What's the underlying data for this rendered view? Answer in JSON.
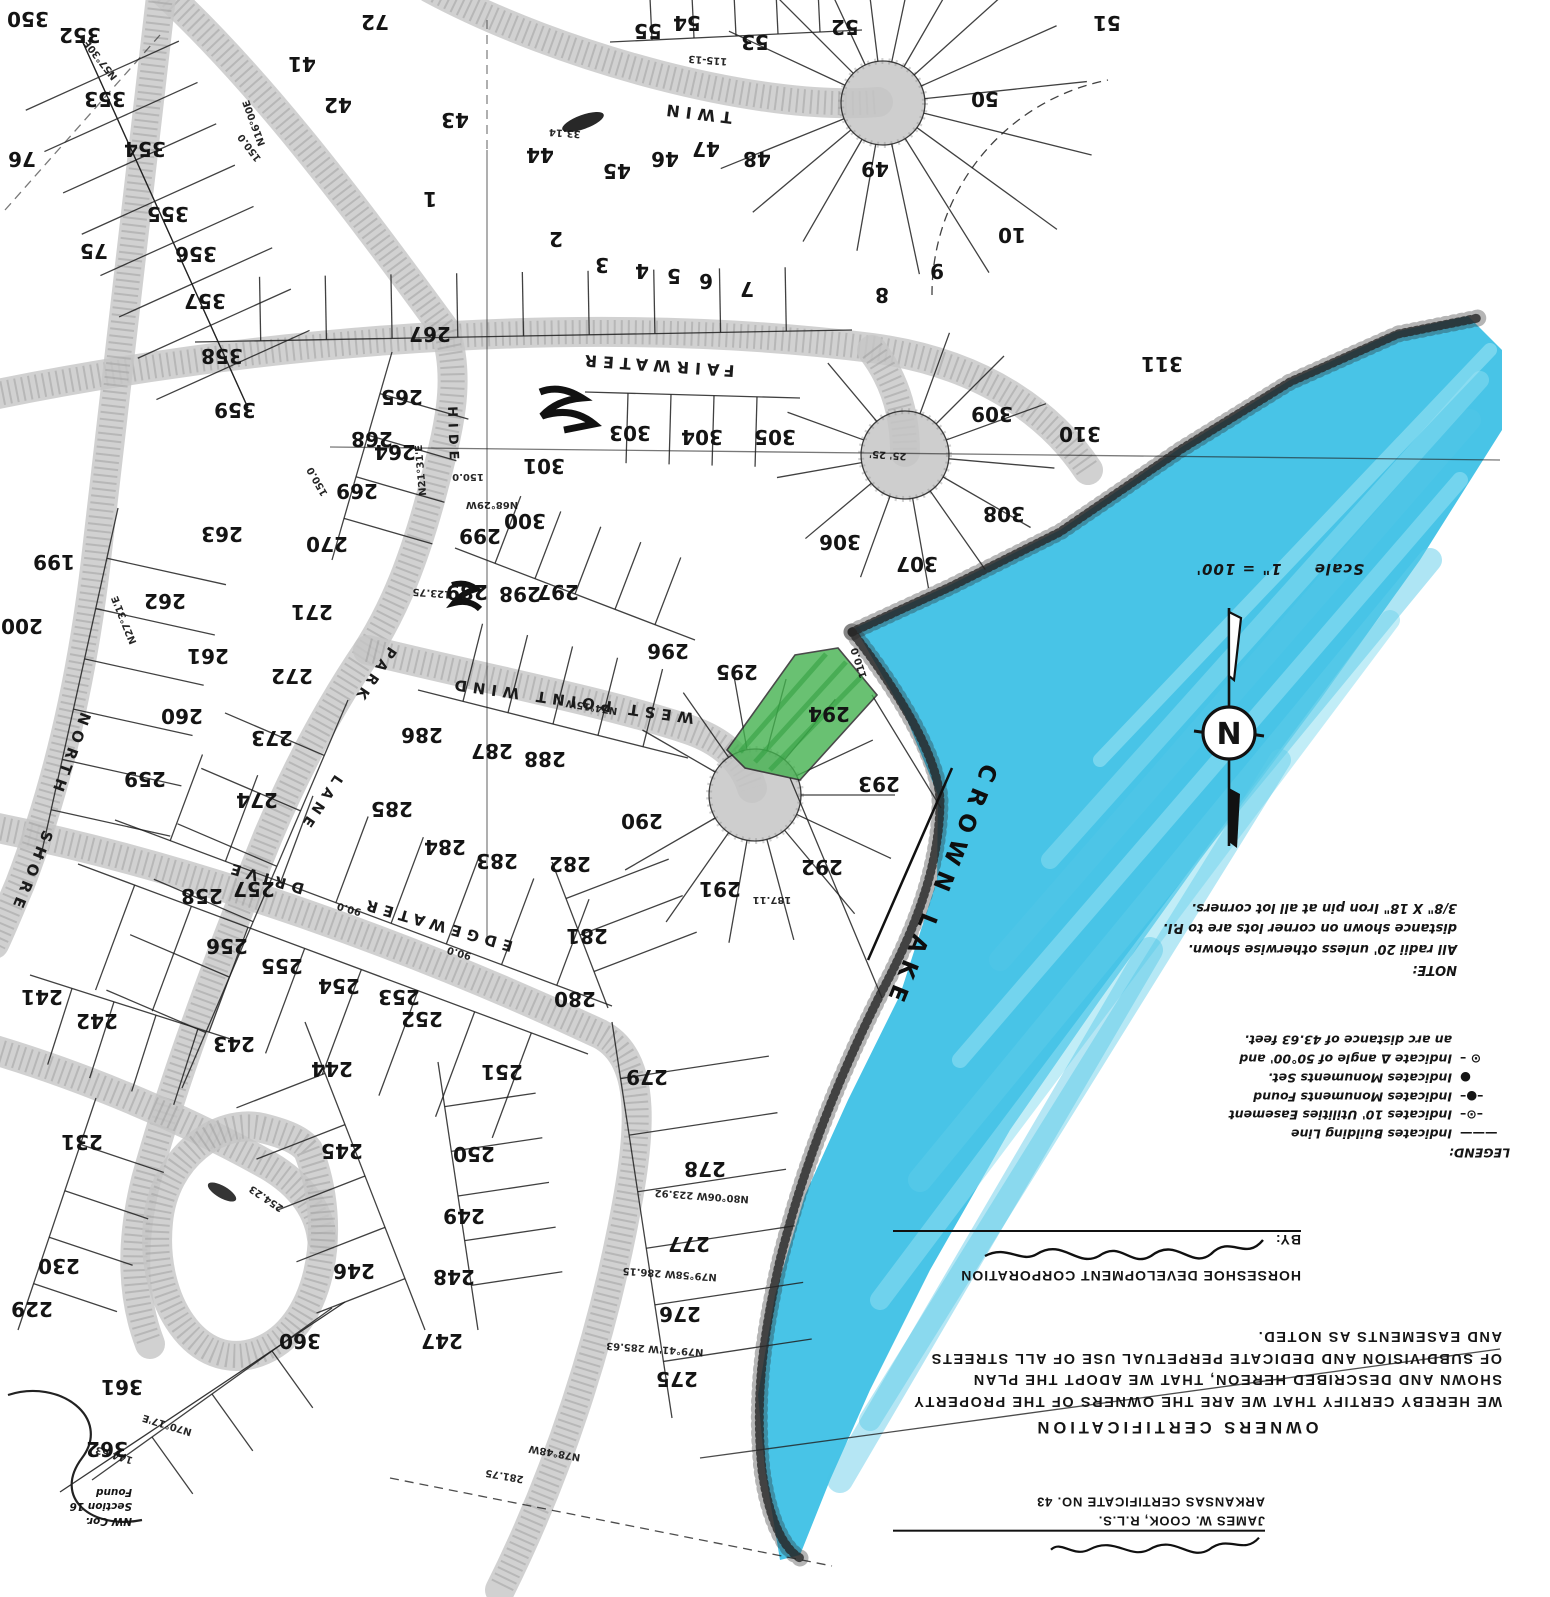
{
  "map": {
    "lake": {
      "name": "CROWN LAKE",
      "marker_color": "#2fbce4"
    },
    "highlight": {
      "lot": "294",
      "color": "#44b24f"
    },
    "scale_label": "Scale",
    "scale_value": "1\" = 100'",
    "north_letter": "N"
  },
  "streets": [
    {
      "name": "TWIN",
      "x": 697,
      "y": 108,
      "r": 187,
      "ls": 8,
      "size": 16
    },
    {
      "name": "FAIRWATER",
      "x": 657,
      "y": 360,
      "r": 184,
      "ls": 6,
      "size": 16
    },
    {
      "name": "WEST  POINT  WIND",
      "x": 572,
      "y": 696,
      "r": 188,
      "ls": 4,
      "size": 15
    },
    {
      "name": "EDGEWATER",
      "x": 438,
      "y": 920,
      "r": 196,
      "ls": 6,
      "size": 15
    },
    {
      "name": "DRIVE",
      "x": 266,
      "y": 873,
      "r": 196,
      "ls": 6,
      "size": 15
    },
    {
      "name": "NORTH",
      "x": 66,
      "y": 753,
      "r": 110,
      "ls": 7,
      "size": 15
    },
    {
      "name": "SHORE",
      "x": 27,
      "y": 870,
      "r": 112,
      "ls": 7,
      "size": 15
    },
    {
      "name": "PARK",
      "x": 371,
      "y": 673,
      "r": 124,
      "ls": 5,
      "size": 14
    },
    {
      "name": "LANE",
      "x": 317,
      "y": 801,
      "r": 124,
      "ls": 5,
      "size": 14
    },
    {
      "name": "HIDE",
      "x": 449,
      "y": 436,
      "r": 88,
      "ls": 6,
      "size": 13
    }
  ],
  "lots": [
    [
      "350",
      28,
      12
    ],
    [
      "352",
      80,
      28
    ],
    [
      "353",
      105,
      92
    ],
    [
      "354",
      145,
      142
    ],
    [
      "355",
      168,
      207
    ],
    [
      "356",
      196,
      247
    ],
    [
      "357",
      205,
      294
    ],
    [
      "358",
      222,
      349
    ],
    [
      "359",
      235,
      403
    ],
    [
      "76",
      22,
      152
    ],
    [
      "75",
      94,
      244
    ],
    [
      "72",
      375,
      15
    ],
    [
      "41",
      302,
      57
    ],
    [
      "42",
      338,
      98
    ],
    [
      "43",
      455,
      113
    ],
    [
      "44",
      540,
      148
    ],
    [
      "45",
      617,
      164
    ],
    [
      "46",
      665,
      152
    ],
    [
      "47",
      706,
      142
    ],
    [
      "48",
      757,
      152
    ],
    [
      "49",
      875,
      162
    ],
    [
      "50",
      985,
      92
    ],
    [
      "51",
      1107,
      16
    ],
    [
      "52",
      845,
      20
    ],
    [
      "53",
      755,
      35
    ],
    [
      "54",
      687,
      16
    ],
    [
      "55",
      648,
      24
    ],
    [
      "1",
      430,
      192
    ],
    [
      "2",
      556,
      232
    ],
    [
      "3",
      602,
      258
    ],
    [
      "4",
      642,
      264
    ],
    [
      "5",
      674,
      269
    ],
    [
      "6",
      706,
      274
    ],
    [
      "7",
      747,
      282
    ],
    [
      "8",
      882,
      288
    ],
    [
      "9",
      937,
      264
    ],
    [
      "10",
      1012,
      228
    ],
    [
      "199",
      54,
      555
    ],
    [
      "200",
      22,
      619
    ],
    [
      "259",
      145,
      772
    ],
    [
      "260",
      182,
      709
    ],
    [
      "261",
      208,
      649
    ],
    [
      "262",
      165,
      594
    ],
    [
      "263",
      222,
      527
    ],
    [
      "264",
      395,
      445
    ],
    [
      "265",
      402,
      390
    ],
    [
      "267",
      430,
      327
    ],
    [
      "268",
      372,
      432
    ],
    [
      "269",
      357,
      484
    ],
    [
      "270",
      327,
      537
    ],
    [
      "271",
      312,
      605
    ],
    [
      "272",
      292,
      669
    ],
    [
      "273",
      272,
      731
    ],
    [
      "274",
      257,
      793
    ],
    [
      "285",
      392,
      802
    ],
    [
      "286",
      422,
      728
    ],
    [
      "287",
      492,
      744
    ],
    [
      "288",
      545,
      752
    ],
    [
      "289",
      467,
      585
    ],
    [
      "298",
      520,
      587
    ],
    [
      "297",
      558,
      585
    ],
    [
      "296",
      668,
      644
    ],
    [
      "295",
      737,
      665
    ],
    [
      "299",
      480,
      529
    ],
    [
      "300",
      525,
      514
    ],
    [
      "301",
      544,
      459
    ],
    [
      "303",
      630,
      426
    ],
    [
      "304",
      702,
      430
    ],
    [
      "305",
      775,
      430
    ],
    [
      "306",
      840,
      535
    ],
    [
      "307",
      917,
      557
    ],
    [
      "308",
      1004,
      507
    ],
    [
      "309",
      992,
      407
    ],
    [
      "310",
      1080,
      427
    ],
    [
      "311",
      1162,
      357
    ],
    [
      "290",
      642,
      814
    ],
    [
      "291",
      720,
      882
    ],
    [
      "292",
      822,
      860
    ],
    [
      "293",
      879,
      777
    ],
    [
      "294",
      829,
      707
    ],
    [
      "282",
      570,
      857
    ],
    [
      "283",
      497,
      854
    ],
    [
      "284",
      445,
      840
    ],
    [
      "281",
      587,
      929
    ],
    [
      "280",
      575,
      992
    ],
    [
      "279",
      647,
      1070
    ],
    [
      "278",
      705,
      1162
    ],
    [
      "277",
      689,
      1237
    ],
    [
      "276",
      680,
      1307
    ],
    [
      "275",
      677,
      1372
    ],
    [
      "258",
      202,
      889
    ],
    [
      "257",
      254,
      882
    ],
    [
      "256",
      227,
      939
    ],
    [
      "255",
      282,
      959
    ],
    [
      "254",
      339,
      979
    ],
    [
      "253",
      399,
      990
    ],
    [
      "252",
      422,
      1012
    ],
    [
      "251",
      502,
      1065
    ],
    [
      "250",
      474,
      1147
    ],
    [
      "249",
      464,
      1209
    ],
    [
      "248",
      454,
      1270
    ],
    [
      "247",
      442,
      1334
    ],
    [
      "246",
      354,
      1264
    ],
    [
      "245",
      342,
      1144
    ],
    [
      "244",
      332,
      1062
    ],
    [
      "243",
      234,
      1037
    ],
    [
      "242",
      97,
      1014
    ],
    [
      "241",
      42,
      990
    ],
    [
      "231",
      82,
      1135
    ],
    [
      "230",
      59,
      1259
    ],
    [
      "229",
      32,
      1302
    ],
    [
      "360",
      300,
      1334
    ],
    [
      "361",
      122,
      1380
    ],
    [
      "362",
      107,
      1442
    ]
  ],
  "bearings": [
    [
      "N70°17'E",
      168,
      1422,
      197
    ],
    [
      "144.63",
      115,
      1452,
      197
    ],
    [
      "N78°48W",
      555,
      1450,
      190
    ],
    [
      "281.75",
      505,
      1473,
      190
    ],
    [
      "N79°41'W 285.63",
      655,
      1346,
      184
    ],
    [
      "N79°58W 286.15",
      670,
      1271,
      184
    ],
    [
      "N80°06W 223.92",
      702,
      1193,
      184
    ],
    [
      "N68°29W",
      492,
      502,
      180
    ],
    [
      "150.0",
      468,
      474,
      180
    ],
    [
      "150.0",
      252,
      146,
      233
    ],
    [
      "N27°31'E",
      127,
      619,
      248
    ],
    [
      "N57°30E",
      103,
      58,
      232
    ],
    [
      "187.11",
      772,
      897,
      180
    ],
    [
      "N74°15W",
      592,
      704,
      189
    ],
    [
      "25' 25'",
      888,
      452,
      184
    ],
    [
      "115-13",
      708,
      57,
      184
    ],
    [
      "110.0",
      862,
      662,
      252
    ],
    [
      "33.14",
      565,
      130,
      184
    ],
    [
      "N16°00E",
      257,
      122,
      250
    ],
    [
      "90.0",
      350,
      906,
      196
    ],
    [
      "90.0",
      460,
      950,
      196
    ],
    [
      "N21°31'E",
      424,
      470,
      265
    ],
    [
      "123.75",
      432,
      590,
      184
    ],
    [
      "254.23",
      268,
      1196,
      214
    ],
    [
      "150.0",
      320,
      480,
      240
    ]
  ],
  "blocks": {
    "note": {
      "title": "NOTE:",
      "lines": [
        "All radii 20' unless otherwise shown.",
        "distance shown on corner lots are to P.I.",
        "3/8\" X 18\" Iron pin at all lot corners."
      ]
    },
    "legend": {
      "title": "LEGEND:",
      "items": [
        {
          "sym": "———",
          "text": "Indicates Building Line"
        },
        {
          "sym": "–⊙–",
          "text": "Indicates 10' Utilities Easement"
        },
        {
          "sym": "–●–",
          "text": "Indicates Monuments Found"
        },
        {
          "sym": "●",
          "text": "Indicates Monuments Set."
        },
        {
          "sym": "⊙ –",
          "text": "Indicate Δ angle of 50°00' and"
        }
      ],
      "cont": "an arc distance of 43.63 feet."
    },
    "certification": {
      "title": "OWNERS  CERTIFICATION",
      "lines": [
        "WE HEREBY CERTIFY THAT WE ARE THE OWNERS OF THE PROPERTY",
        "SHOWN AND DESCRIBED HEREON, THAT WE ADOPT THE PLAN",
        "OF SUBDIVISION AND DEDICATE PERPETUAL USE OF ALL STREETS",
        "AND EASEMENTS AS NOTED."
      ],
      "company": "HORSESHOE  DEVELOPMENT  CORPORATION",
      "by_label": "BY:"
    },
    "surveyor": {
      "name": "JAMES W. COOK,  R.L.S.",
      "cert": "ARKANSAS CERTIFICATE  NO. 43"
    },
    "corner_note": {
      "lines": [
        "NW Cor.",
        "Section 16",
        "Found"
      ]
    }
  }
}
